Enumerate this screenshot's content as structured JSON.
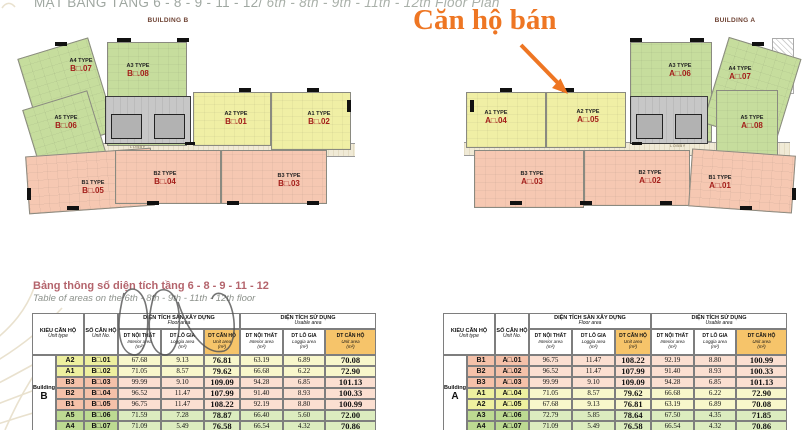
{
  "page_title": {
    "vi": "MẶT BẰNG TẦNG 6 - 8 - 9 - 11 - 12/ ",
    "en": "6th - 8th - 9th - 11th - 12th Floor Plan"
  },
  "sale_annotation": {
    "label": "Căn hộ bán"
  },
  "colors": {
    "accent_orange": "#ee7623",
    "unit_number_red": "#a31e1a",
    "header_highlight": "#f6c46a",
    "unit_green": "#c6dd9d",
    "unit_yellow": "#f0efa5",
    "unit_pink": "#f6c8b2"
  },
  "plans": [
    {
      "name": "BUILDING B",
      "lobby_label": "LOBBY",
      "units": [
        {
          "id": "b07",
          "type_label": "A4 TYPE",
          "no_label": "B□.07",
          "color": "green"
        },
        {
          "id": "b08",
          "type_label": "A3 TYPE",
          "no_label": "B□.08",
          "color": "green"
        },
        {
          "id": "b06",
          "type_label": "A5 TYPE",
          "no_label": "B□.06",
          "color": "green"
        },
        {
          "id": "b01",
          "type_label": "A2 TYPE",
          "no_label": "B□.01",
          "color": "yellow"
        },
        {
          "id": "b02",
          "type_label": "A1 TYPE",
          "no_label": "B□.02",
          "color": "yellow"
        },
        {
          "id": "b05",
          "type_label": "B1 TYPE",
          "no_label": "B□.05",
          "color": "pink"
        },
        {
          "id": "b04",
          "type_label": "B2 TYPE",
          "no_label": "B□.04",
          "color": "pink"
        },
        {
          "id": "b03",
          "type_label": "B3 TYPE",
          "no_label": "B□.03",
          "color": "pink"
        }
      ]
    },
    {
      "name": "BUILDING A",
      "lobby_label": "LOBBY",
      "units": [
        {
          "id": "a04",
          "type_label": "A1 TYPE",
          "no_label": "A□.04",
          "color": "yellow"
        },
        {
          "id": "a05",
          "type_label": "A2 TYPE",
          "no_label": "A□.05",
          "color": "yellow"
        },
        {
          "id": "a06",
          "type_label": "A3 TYPE",
          "no_label": "A□.06",
          "color": "green"
        },
        {
          "id": "a07",
          "type_label": "A4 TYPE",
          "no_label": "A□.07",
          "color": "green"
        },
        {
          "id": "a08",
          "type_label": "A5 TYPE",
          "no_label": "A□.08",
          "color": "green"
        },
        {
          "id": "a03",
          "type_label": "B3 TYPE",
          "no_label": "A□.03",
          "color": "pink"
        },
        {
          "id": "a02",
          "type_label": "B2 TYPE",
          "no_label": "A□.02",
          "color": "pink"
        },
        {
          "id": "a01",
          "type_label": "B1 TYPE",
          "no_label": "A□.01",
          "color": "pink"
        }
      ]
    }
  ],
  "area_table": {
    "title_vi": "Bảng thông số diện tích tầng 6 - 8 - 9 - 11 - 12",
    "title_en": "Table of areas on the 6th - 8th - 9th - 11th - 12th floor",
    "headers": {
      "unit_type": {
        "vi": "KIỂU CĂN HỘ",
        "en": "Unit type"
      },
      "unit_no": {
        "vi": "SỐ CĂN HỘ",
        "en": "Unit No."
      },
      "groups": [
        {
          "vi": "DIỆN TÍCH SÀN XÂY DỰNG",
          "en": "Floor area"
        },
        {
          "vi": "DIỆN TÍCH SỬ DỤNG",
          "en": "Usable area"
        }
      ],
      "sub": [
        {
          "vi": "DT NỘI THẤT",
          "en": "Interior area",
          "unit": "(m²)"
        },
        {
          "vi": "DT LÔ GIA",
          "en": "Loggia area",
          "unit": "(m²)"
        },
        {
          "vi": "DT CĂN HỘ",
          "en": "Unit area",
          "unit": "(m²)"
        }
      ]
    },
    "tables": [
      {
        "building": "Building B",
        "rows": [
          {
            "type": "A2",
            "no": "B□.01",
            "color": "yellow",
            "values": [
              "67.68",
              "9.13",
              "76.81",
              "63.19",
              "6.89",
              "70.08"
            ]
          },
          {
            "type": "A1",
            "no": "B□.02",
            "color": "yellow",
            "values": [
              "71.05",
              "8.57",
              "79.62",
              "66.68",
              "6.22",
              "72.90"
            ]
          },
          {
            "type": "B3",
            "no": "B□.03",
            "color": "pink",
            "values": [
              "99.99",
              "9.10",
              "109.09",
              "94.28",
              "6.85",
              "101.13"
            ]
          },
          {
            "type": "B2",
            "no": "B□.04",
            "color": "pink",
            "values": [
              "96.52",
              "11.47",
              "107.99",
              "91.40",
              "8.93",
              "100.33"
            ]
          },
          {
            "type": "B1",
            "no": "B□.05",
            "color": "pink",
            "values": [
              "96.75",
              "11.47",
              "108.22",
              "92.19",
              "8.80",
              "100.99"
            ]
          },
          {
            "type": "A5",
            "no": "B□.06",
            "color": "green",
            "values": [
              "71.59",
              "7.28",
              "78.87",
              "66.40",
              "5.60",
              "72.00"
            ]
          },
          {
            "type": "A4",
            "no": "B□.07",
            "color": "green",
            "values": [
              "71.09",
              "5.49",
              "76.58",
              "66.54",
              "4.32",
              "70.86"
            ]
          }
        ]
      },
      {
        "building": "Building A",
        "rows": [
          {
            "type": "B1",
            "no": "A□.01",
            "color": "pink",
            "values": [
              "96.75",
              "11.47",
              "108.22",
              "92.19",
              "8.80",
              "100.99"
            ]
          },
          {
            "type": "B2",
            "no": "A□.02",
            "color": "pink",
            "values": [
              "96.52",
              "11.47",
              "107.99",
              "91.40",
              "8.93",
              "100.33"
            ]
          },
          {
            "type": "B3",
            "no": "A□.03",
            "color": "pink",
            "values": [
              "99.99",
              "9.10",
              "109.09",
              "94.28",
              "6.85",
              "101.13"
            ]
          },
          {
            "type": "A1",
            "no": "A□.04",
            "color": "yellow",
            "values": [
              "71.05",
              "8.57",
              "79.62",
              "66.68",
              "6.22",
              "72.90"
            ]
          },
          {
            "type": "A2",
            "no": "A□.05",
            "color": "yellow",
            "values": [
              "67.68",
              "9.13",
              "76.81",
              "63.19",
              "6.89",
              "70.08"
            ]
          },
          {
            "type": "A3",
            "no": "A□.06",
            "color": "green",
            "values": [
              "72.79",
              "5.85",
              "78.64",
              "67.50",
              "4.35",
              "71.85"
            ]
          },
          {
            "type": "A4",
            "no": "A□.07",
            "color": "green",
            "values": [
              "71.09",
              "5.49",
              "76.58",
              "66.54",
              "4.32",
              "70.86"
            ]
          }
        ]
      }
    ]
  }
}
